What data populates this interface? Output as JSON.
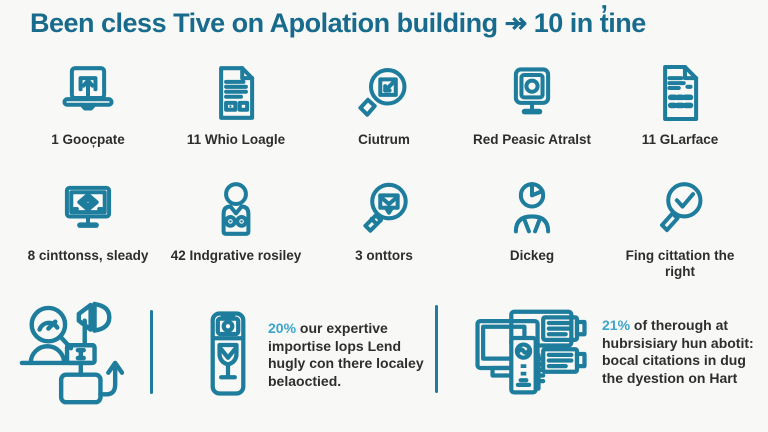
{
  "title": "Been cless Tive on Apolation building ↠ 10 in t̓ine",
  "colors": {
    "background": "#f8f9f6",
    "title": "#186b8c",
    "icon_stroke": "#1e7d9d",
    "label_text": "#2d2d2d",
    "percent_accent": "#3ba5cd",
    "divider": "#1e7d9d"
  },
  "grid": {
    "row1": [
      {
        "label": "1 Gooc̦pate",
        "icon": "laptop-upload-icon"
      },
      {
        "label": "11 Whio Loagle",
        "icon": "document-lines-icon"
      },
      {
        "label": "Ciutrum",
        "icon": "magnifier-select-icon"
      },
      {
        "label": "Red Peasic Atralst",
        "icon": "monitor-camera-icon"
      },
      {
        "label": "11 GLarface",
        "icon": "invoice-document-icon"
      }
    ],
    "row2": [
      {
        "label": "8 cinttonss, sleady",
        "icon": "monitor-qr-icon"
      },
      {
        "label": "42 Indgrative rosiley",
        "icon": "person-vest-icon"
      },
      {
        "label": "3 onttors",
        "icon": "magnifier-mail-icon"
      },
      {
        "label": "Dickeg",
        "icon": "person-pie-chart-icon"
      },
      {
        "label": "Fing cittation the right",
        "icon": "magnifier-check-icon"
      }
    ]
  },
  "stats": [
    {
      "percent": "20%",
      "text": "our expertive importise lops Lend hugly con there localey belaoctied.",
      "icon": "camera-wine-card-icon"
    },
    {
      "percent": "21%",
      "text": "of therough at hubrsisiary hun abotit: bocal citations in dug the dyestion on Hart",
      "icon": "computers-server-icon"
    }
  ],
  "bottom_left_icon": "promotion-workflow-icon"
}
